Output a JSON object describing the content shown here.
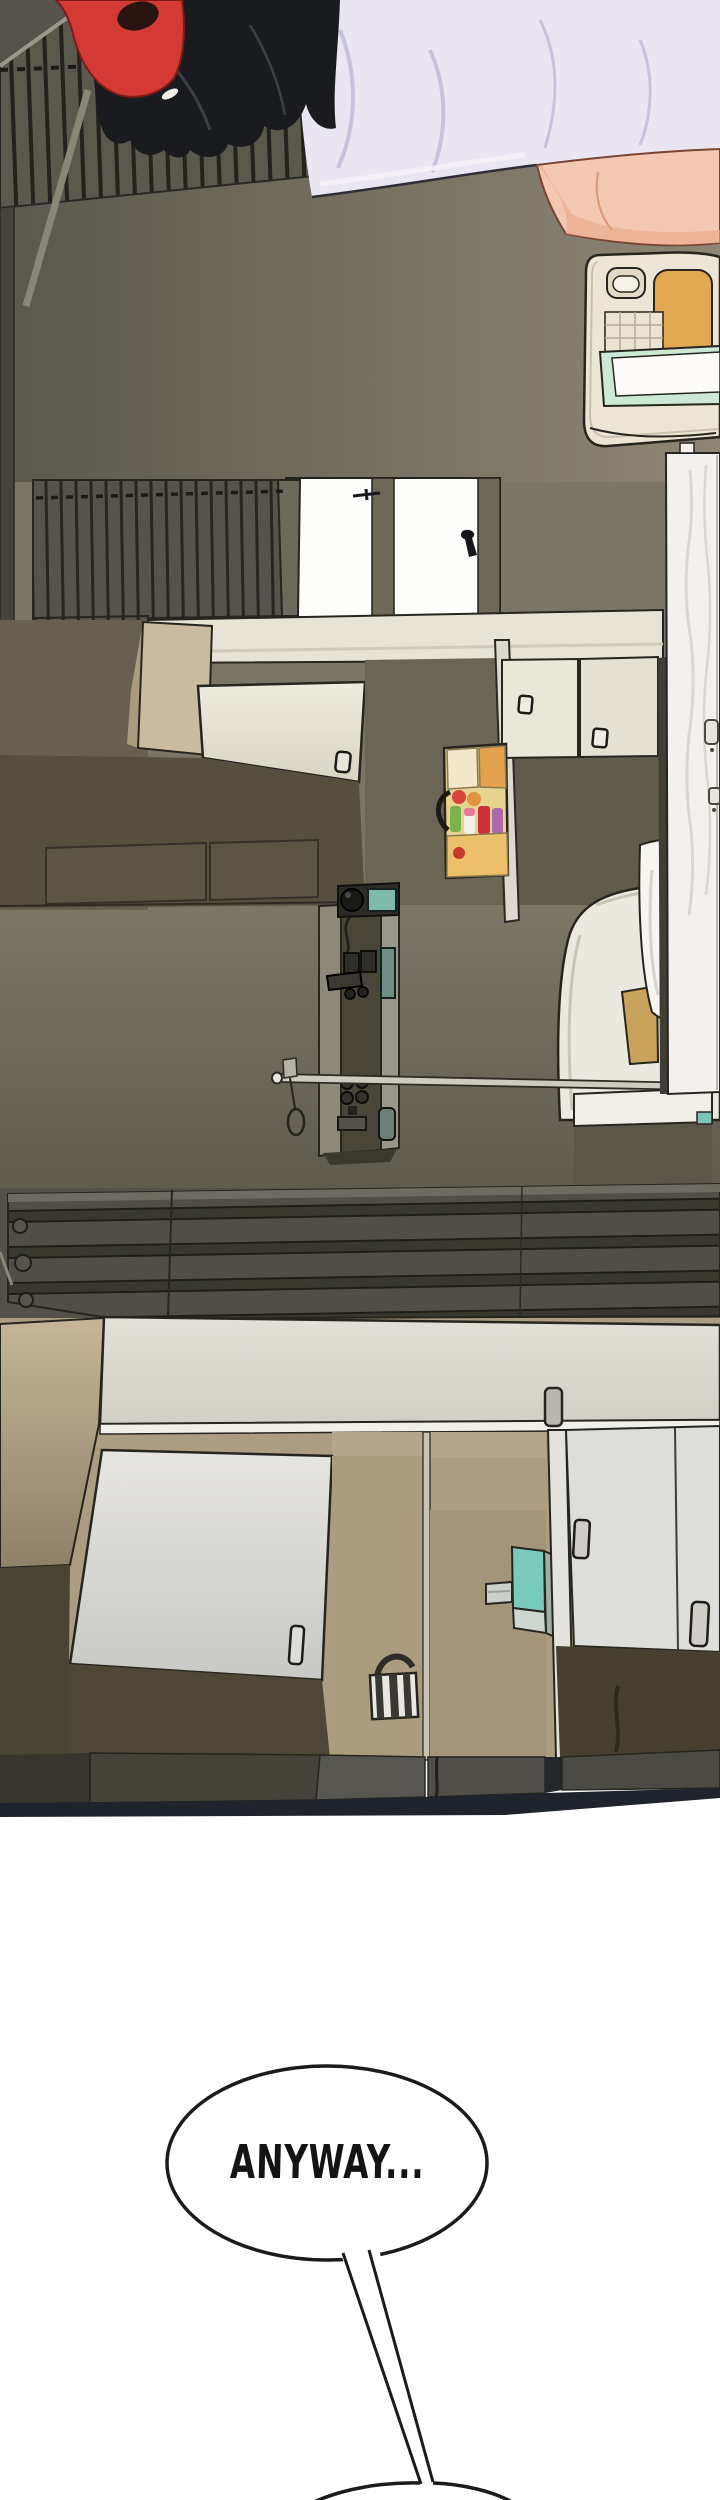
{
  "page": {
    "width": 720,
    "height": 2500,
    "background": "#ffffff"
  },
  "speech_bubble": {
    "text": "ANYWAY..."
  },
  "next_bubble": {
    "partially_visible": true
  },
  "colors": {
    "outline": "#1b1b1b",
    "wall_olive_light": "#8e8675",
    "wall_olive_dark": "#5a574d",
    "wall_mid": "#7b7567",
    "floor": "#6f6a5c",
    "grate_dark": "#23221e",
    "counter_cream": "#e7e3d6",
    "cabinet_cream": "#e9e6da",
    "tan_panel": "#c9bb9f",
    "tan_wall": "#b3a589",
    "dark_cabinet": "#574f3e",
    "window_light": "#fdfdfb",
    "window_frame": "#6e6857",
    "appliance_white": "#f3f1ed",
    "slab_cream": "#dedbd2",
    "hair_black": "#1a1b1f",
    "headphone_red": "#d23a33",
    "shirt_lavender": "#eae6f1",
    "shirt_fold": "#c9c1dc",
    "skin": "#f3c8b3",
    "skin_shadow": "#eaa98e",
    "teal_accent": "#7acabc",
    "mustard_accent": "#c9a25c",
    "mint_board": "#cde8d5",
    "orange_pad": "#e1aa52",
    "rack_yellow": "#e6d48e",
    "bottle_red": "#cc3038",
    "bottle_green": "#7cb14c",
    "bottle_purple": "#ad68ae",
    "base_navy": "#1f232b"
  }
}
